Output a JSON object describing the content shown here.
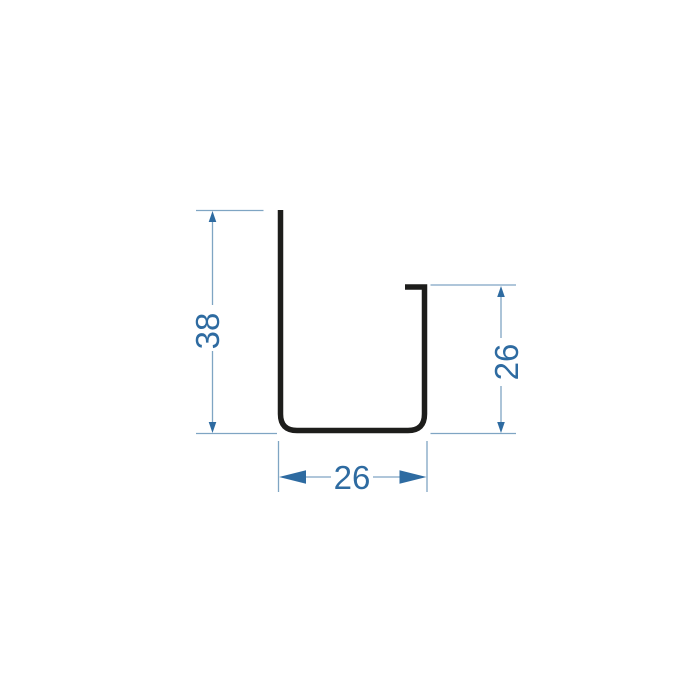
{
  "diagram": {
    "description": "channel-profile-cross-section-drawing",
    "labels": {
      "height": "38",
      "lip": "26",
      "width": "26"
    },
    "colors": {
      "background": "#ffffff",
      "profile": "#1d1d1b",
      "dimension_line": "#7fa5c3",
      "dimension_accent": "#2e6ba1"
    }
  }
}
